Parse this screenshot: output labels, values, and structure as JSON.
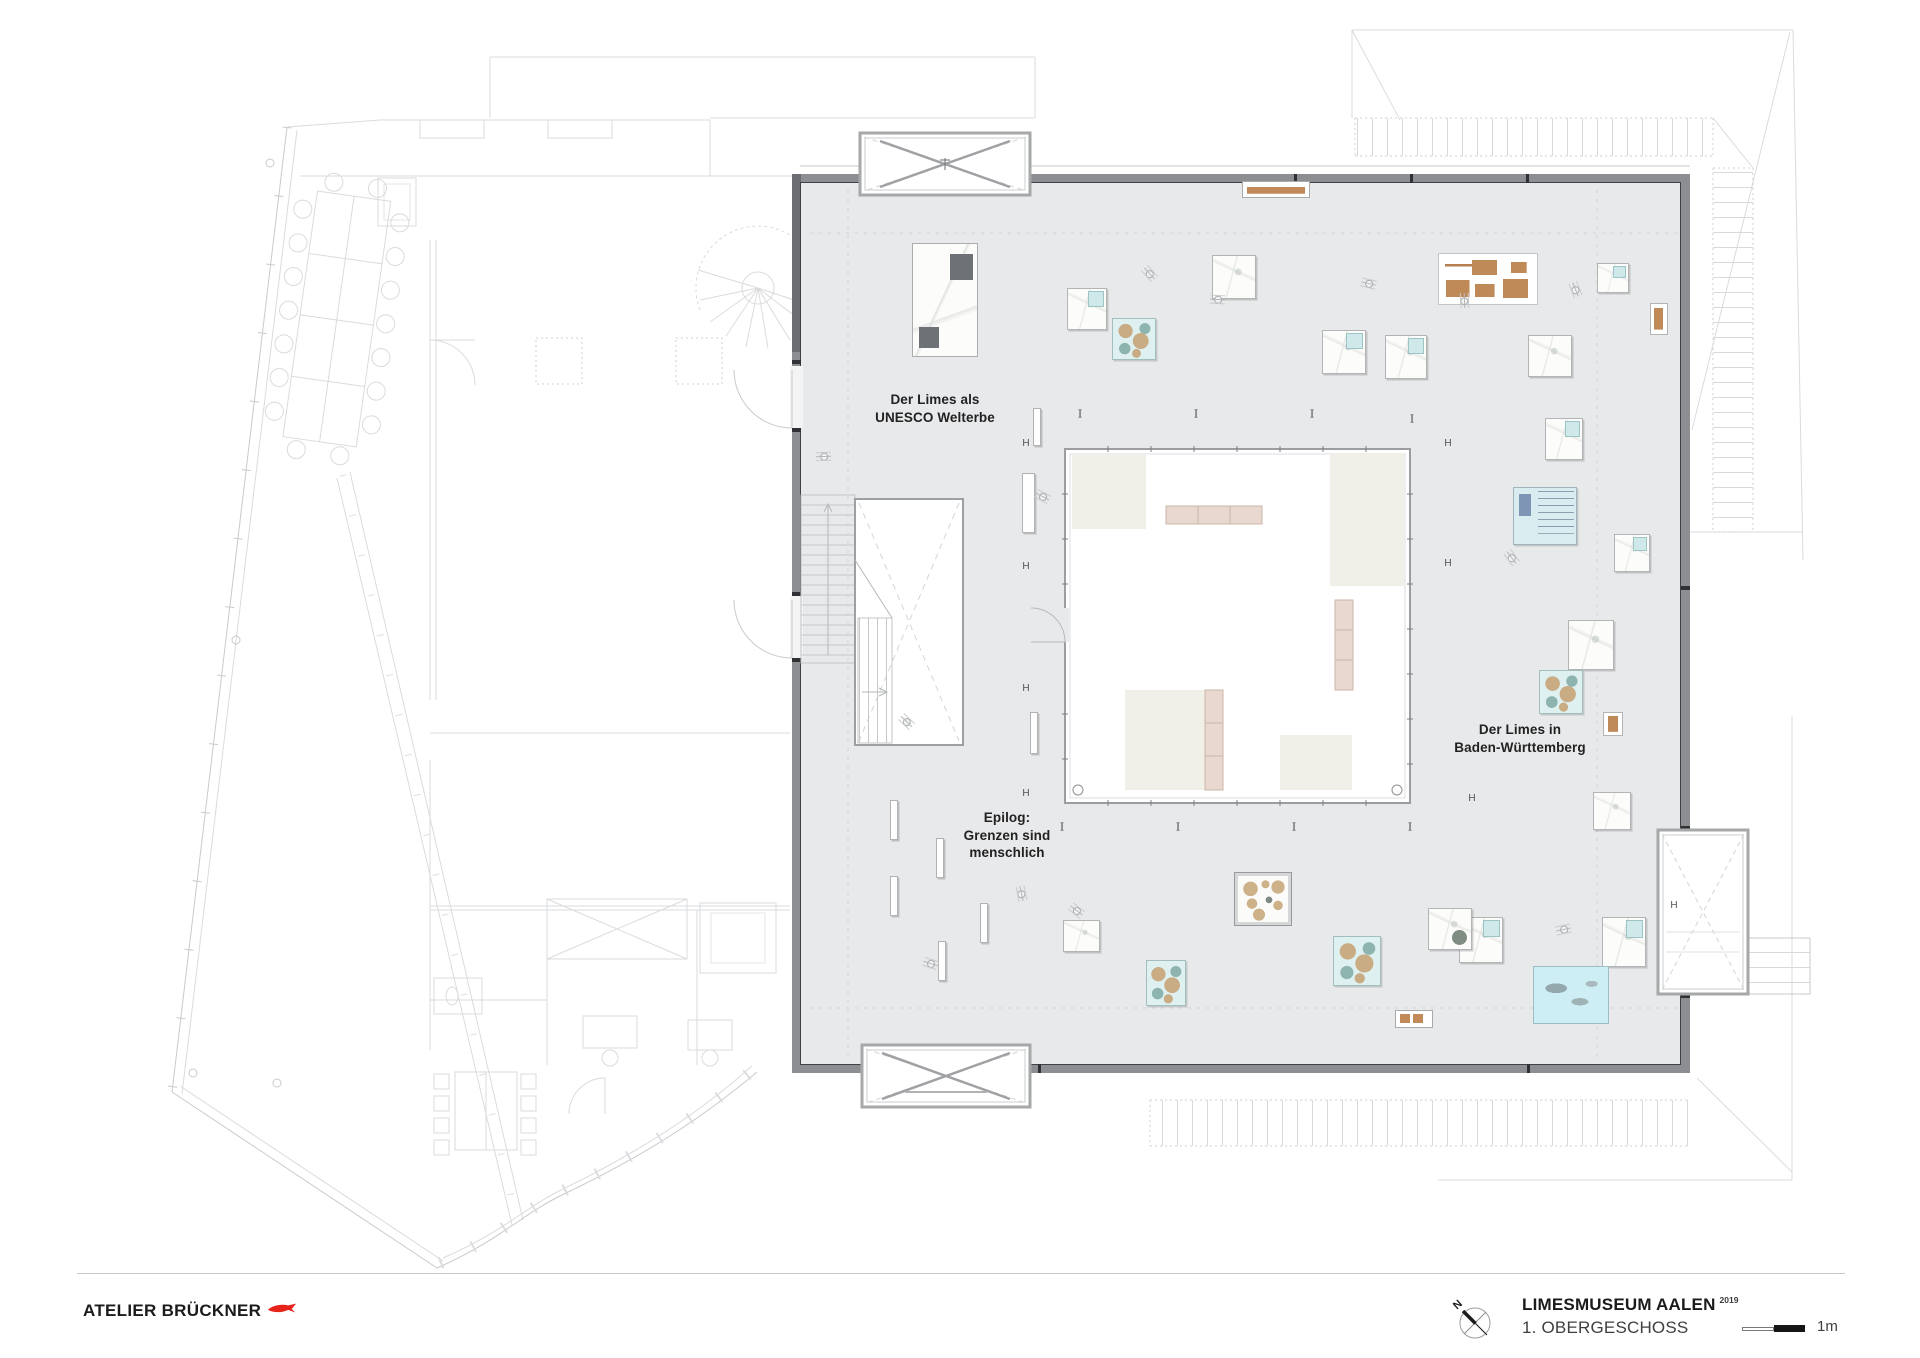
{
  "branding": {
    "studio": "ATELIER BRÜCKNER"
  },
  "title_block": {
    "project": "LIMESMUSEUM AALEN",
    "year": "2019",
    "floor": "1. OBERGESCHOSS",
    "scale_label": "1m",
    "north_label": "N"
  },
  "plan": {
    "labels": [
      {
        "id": "unesco",
        "text": "Der Limes als\nUNESCO Welterbe",
        "x": 935,
        "y": 391
      },
      {
        "id": "limes-bw",
        "text": "Der Limes in\nBaden-Württemberg",
        "x": 1520,
        "y": 721
      },
      {
        "id": "epilog",
        "text": "Epilog:\nGrenzen sind\nmenschlich",
        "x": 1007,
        "y": 809
      }
    ],
    "markers": {
      "h_glyph": "H",
      "i_glyph": "I",
      "h": [
        [
          1026,
          444
        ],
        [
          1026,
          567
        ],
        [
          1026,
          689
        ],
        [
          1026,
          794
        ],
        [
          1448,
          444
        ],
        [
          1448,
          564
        ],
        [
          1472,
          799
        ],
        [
          1674,
          906
        ]
      ],
      "i": [
        [
          1080,
          414
        ],
        [
          1196,
          414
        ],
        [
          1312,
          414
        ],
        [
          1412,
          419
        ],
        [
          1062,
          827
        ],
        [
          1178,
          827
        ],
        [
          1294,
          827
        ],
        [
          1410,
          827
        ]
      ]
    },
    "exhibits": [
      {
        "type": "maplarge",
        "x": 912,
        "y": 243,
        "w": 66,
        "h": 114
      },
      {
        "type": "mapt",
        "x": 1067,
        "y": 288,
        "w": 40,
        "h": 42
      },
      {
        "type": "teal",
        "x": 1112,
        "y": 318,
        "w": 44,
        "h": 42
      },
      {
        "type": "map",
        "x": 1212,
        "y": 255,
        "w": 44,
        "h": 44
      },
      {
        "type": "mapt",
        "x": 1322,
        "y": 330,
        "w": 44,
        "h": 44
      },
      {
        "type": "mapt",
        "x": 1385,
        "y": 335,
        "w": 42,
        "h": 44
      },
      {
        "type": "brownset",
        "x": 1438,
        "y": 253,
        "w": 100,
        "h": 52
      },
      {
        "type": "map",
        "x": 1528,
        "y": 335,
        "w": 44,
        "h": 42
      },
      {
        "type": "mapt",
        "x": 1597,
        "y": 263,
        "w": 32,
        "h": 30
      },
      {
        "type": "brownframed",
        "x": 1650,
        "y": 303,
        "w": 18,
        "h": 32
      },
      {
        "type": "benchtop",
        "x": 1242,
        "y": 181,
        "w": 68,
        "h": 17
      },
      {
        "type": "mapt",
        "x": 1545,
        "y": 418,
        "w": 38,
        "h": 42
      },
      {
        "type": "bluelist",
        "x": 1513,
        "y": 487,
        "w": 64,
        "h": 58
      },
      {
        "type": "mapt",
        "x": 1614,
        "y": 534,
        "w": 36,
        "h": 38
      },
      {
        "type": "map",
        "x": 1568,
        "y": 620,
        "w": 46,
        "h": 50
      },
      {
        "type": "teal",
        "x": 1539,
        "y": 670,
        "w": 44,
        "h": 44
      },
      {
        "type": "brownframed",
        "x": 1603,
        "y": 712,
        "w": 20,
        "h": 24
      },
      {
        "type": "map",
        "x": 1593,
        "y": 792,
        "w": 38,
        "h": 38
      },
      {
        "type": "mapt",
        "x": 1459,
        "y": 917,
        "w": 44,
        "h": 46
      },
      {
        "type": "mapt",
        "x": 1602,
        "y": 917,
        "w": 44,
        "h": 50
      },
      {
        "type": "bigcyan",
        "x": 1533,
        "y": 966,
        "w": 76,
        "h": 58
      },
      {
        "type": "bench2",
        "x": 1395,
        "y": 1010,
        "w": 38,
        "h": 18
      },
      {
        "type": "coin",
        "x": 1235,
        "y": 873,
        "w": 56,
        "h": 52
      },
      {
        "type": "teal",
        "x": 1333,
        "y": 936,
        "w": 48,
        "h": 50
      },
      {
        "type": "mapdot",
        "x": 1428,
        "y": 908,
        "w": 44,
        "h": 42
      },
      {
        "type": "teal",
        "x": 1146,
        "y": 960,
        "w": 40,
        "h": 46
      },
      {
        "type": "map",
        "x": 1063,
        "y": 920,
        "w": 37,
        "h": 32
      },
      {
        "type": "panel",
        "x": 890,
        "y": 800,
        "w": 8,
        "h": 40
      },
      {
        "type": "panel",
        "x": 936,
        "y": 838,
        "w": 8,
        "h": 40
      },
      {
        "type": "panel",
        "x": 890,
        "y": 876,
        "w": 8,
        "h": 40
      },
      {
        "type": "panel",
        "x": 980,
        "y": 903,
        "w": 8,
        "h": 40
      },
      {
        "type": "panel",
        "x": 938,
        "y": 941,
        "w": 8,
        "h": 40
      },
      {
        "type": "panel",
        "x": 1022,
        "y": 473,
        "w": 13,
        "h": 60
      },
      {
        "type": "panel",
        "x": 1030,
        "y": 712,
        "w": 8,
        "h": 42
      },
      {
        "type": "panel",
        "x": 1033,
        "y": 408,
        "w": 8,
        "h": 38
      }
    ],
    "persons": [
      {
        "x": 1142,
        "y": 266,
        "r": 20
      },
      {
        "x": 1210,
        "y": 292,
        "r": -25
      },
      {
        "x": 1361,
        "y": 276,
        "r": -15
      },
      {
        "x": 1457,
        "y": 293,
        "r": 60
      },
      {
        "x": 1568,
        "y": 282,
        "r": 40
      },
      {
        "x": 1035,
        "y": 489,
        "r": 0
      },
      {
        "x": 816,
        "y": 449,
        "r": -30
      },
      {
        "x": 899,
        "y": 714,
        "r": 15
      },
      {
        "x": 1014,
        "y": 886,
        "r": 50
      },
      {
        "x": 923,
        "y": 956,
        "r": -10
      },
      {
        "x": 1504,
        "y": 550,
        "r": 25
      },
      {
        "x": 1556,
        "y": 922,
        "r": -40
      },
      {
        "x": 1069,
        "y": 903,
        "r": 10
      }
    ]
  }
}
